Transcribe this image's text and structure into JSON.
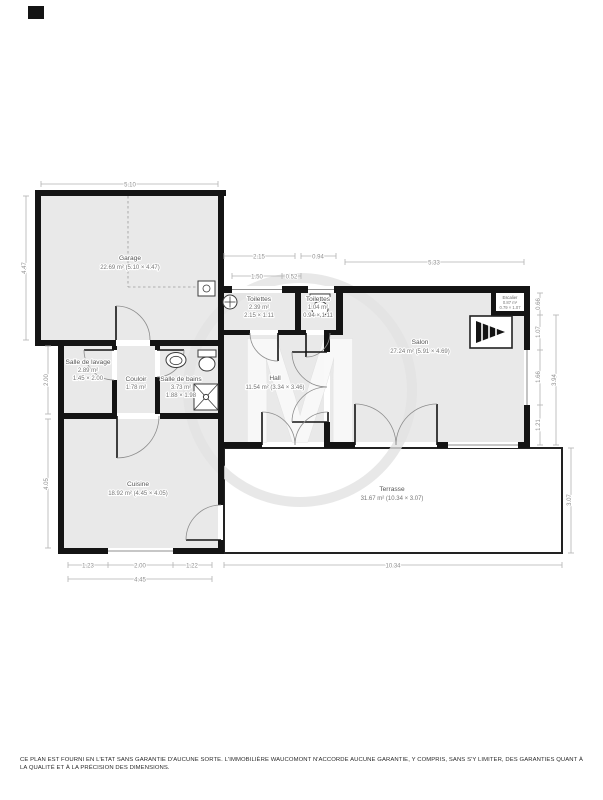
{
  "watermark": {
    "letter": "M"
  },
  "rooms": {
    "garage": {
      "name": "Garage",
      "detail": "22.69 m² (5.10 × 4.47)"
    },
    "salle_de_lavage": {
      "name": "Salle de lavage",
      "area": "2.89 m²",
      "dims": "1.45 × 2.00"
    },
    "couloir": {
      "name": "Couloir",
      "area": "1.78 m²"
    },
    "salle_de_bains": {
      "name": "Salle de bains",
      "area": "3.73 m²",
      "dims": "1.88 × 1.98"
    },
    "toilettes": {
      "name": "Toilettes",
      "area": "2.39 m²",
      "dims": "2.15 × 1.11"
    },
    "toilettes_2": {
      "name": "Toilettes",
      "area": "1.04 m²",
      "dims": "0.94 × 1.11"
    },
    "hall": {
      "name": "Hall",
      "detail": "11.54 m² (3.34 × 3.46)"
    },
    "salon": {
      "name": "Salon",
      "detail": "27.24 m² (5.91 × 4.69)"
    },
    "escalier": {
      "name": "Escalier",
      "area": "0.87 m²",
      "dims": "0.79 × 1.07"
    },
    "cuisine": {
      "name": "Cuisine",
      "detail": "18.92 m² (4.45 × 4.05)"
    },
    "terrasse": {
      "name": "Terrasse",
      "detail": "31.67 m² (10.34 × 3.07)"
    }
  },
  "dimensions": {
    "garage_width": "5.10",
    "garage_height": "4.47",
    "lavage_height": "2.00",
    "cuisine_height": "4.05",
    "toilettes_width": "2.15",
    "toilettes2_width": "0.94",
    "toilettes_window": "1.50",
    "toilettes_wall": "0.52",
    "salon_width": "5.33",
    "right_1": "0.66",
    "right_2": "1.07",
    "right_3": "1.66",
    "right_4": "1.21",
    "right_total": "3.94",
    "bottom_left": "1.23",
    "bottom_window": "2.00",
    "bottom_right": "1.22",
    "bottom_total": "4.45",
    "terrasse_width": "10.34",
    "terrasse_height": "3.07"
  },
  "footer": {
    "disclaimer": "CE PLAN EST FOURNI EN L'ETAT SANS GARANTIE D'AUCUNE SORTE. L'IMMOBILIÈRE WAUCOMONT N'ACCORDE AUCUNE GARANTIE, Y COMPRIS, SANS S'Y LIMITER, DES GARANTIES QUANT À LA QUALITÉ ET À LA PRÉCISION DES DIMENSIONS."
  }
}
